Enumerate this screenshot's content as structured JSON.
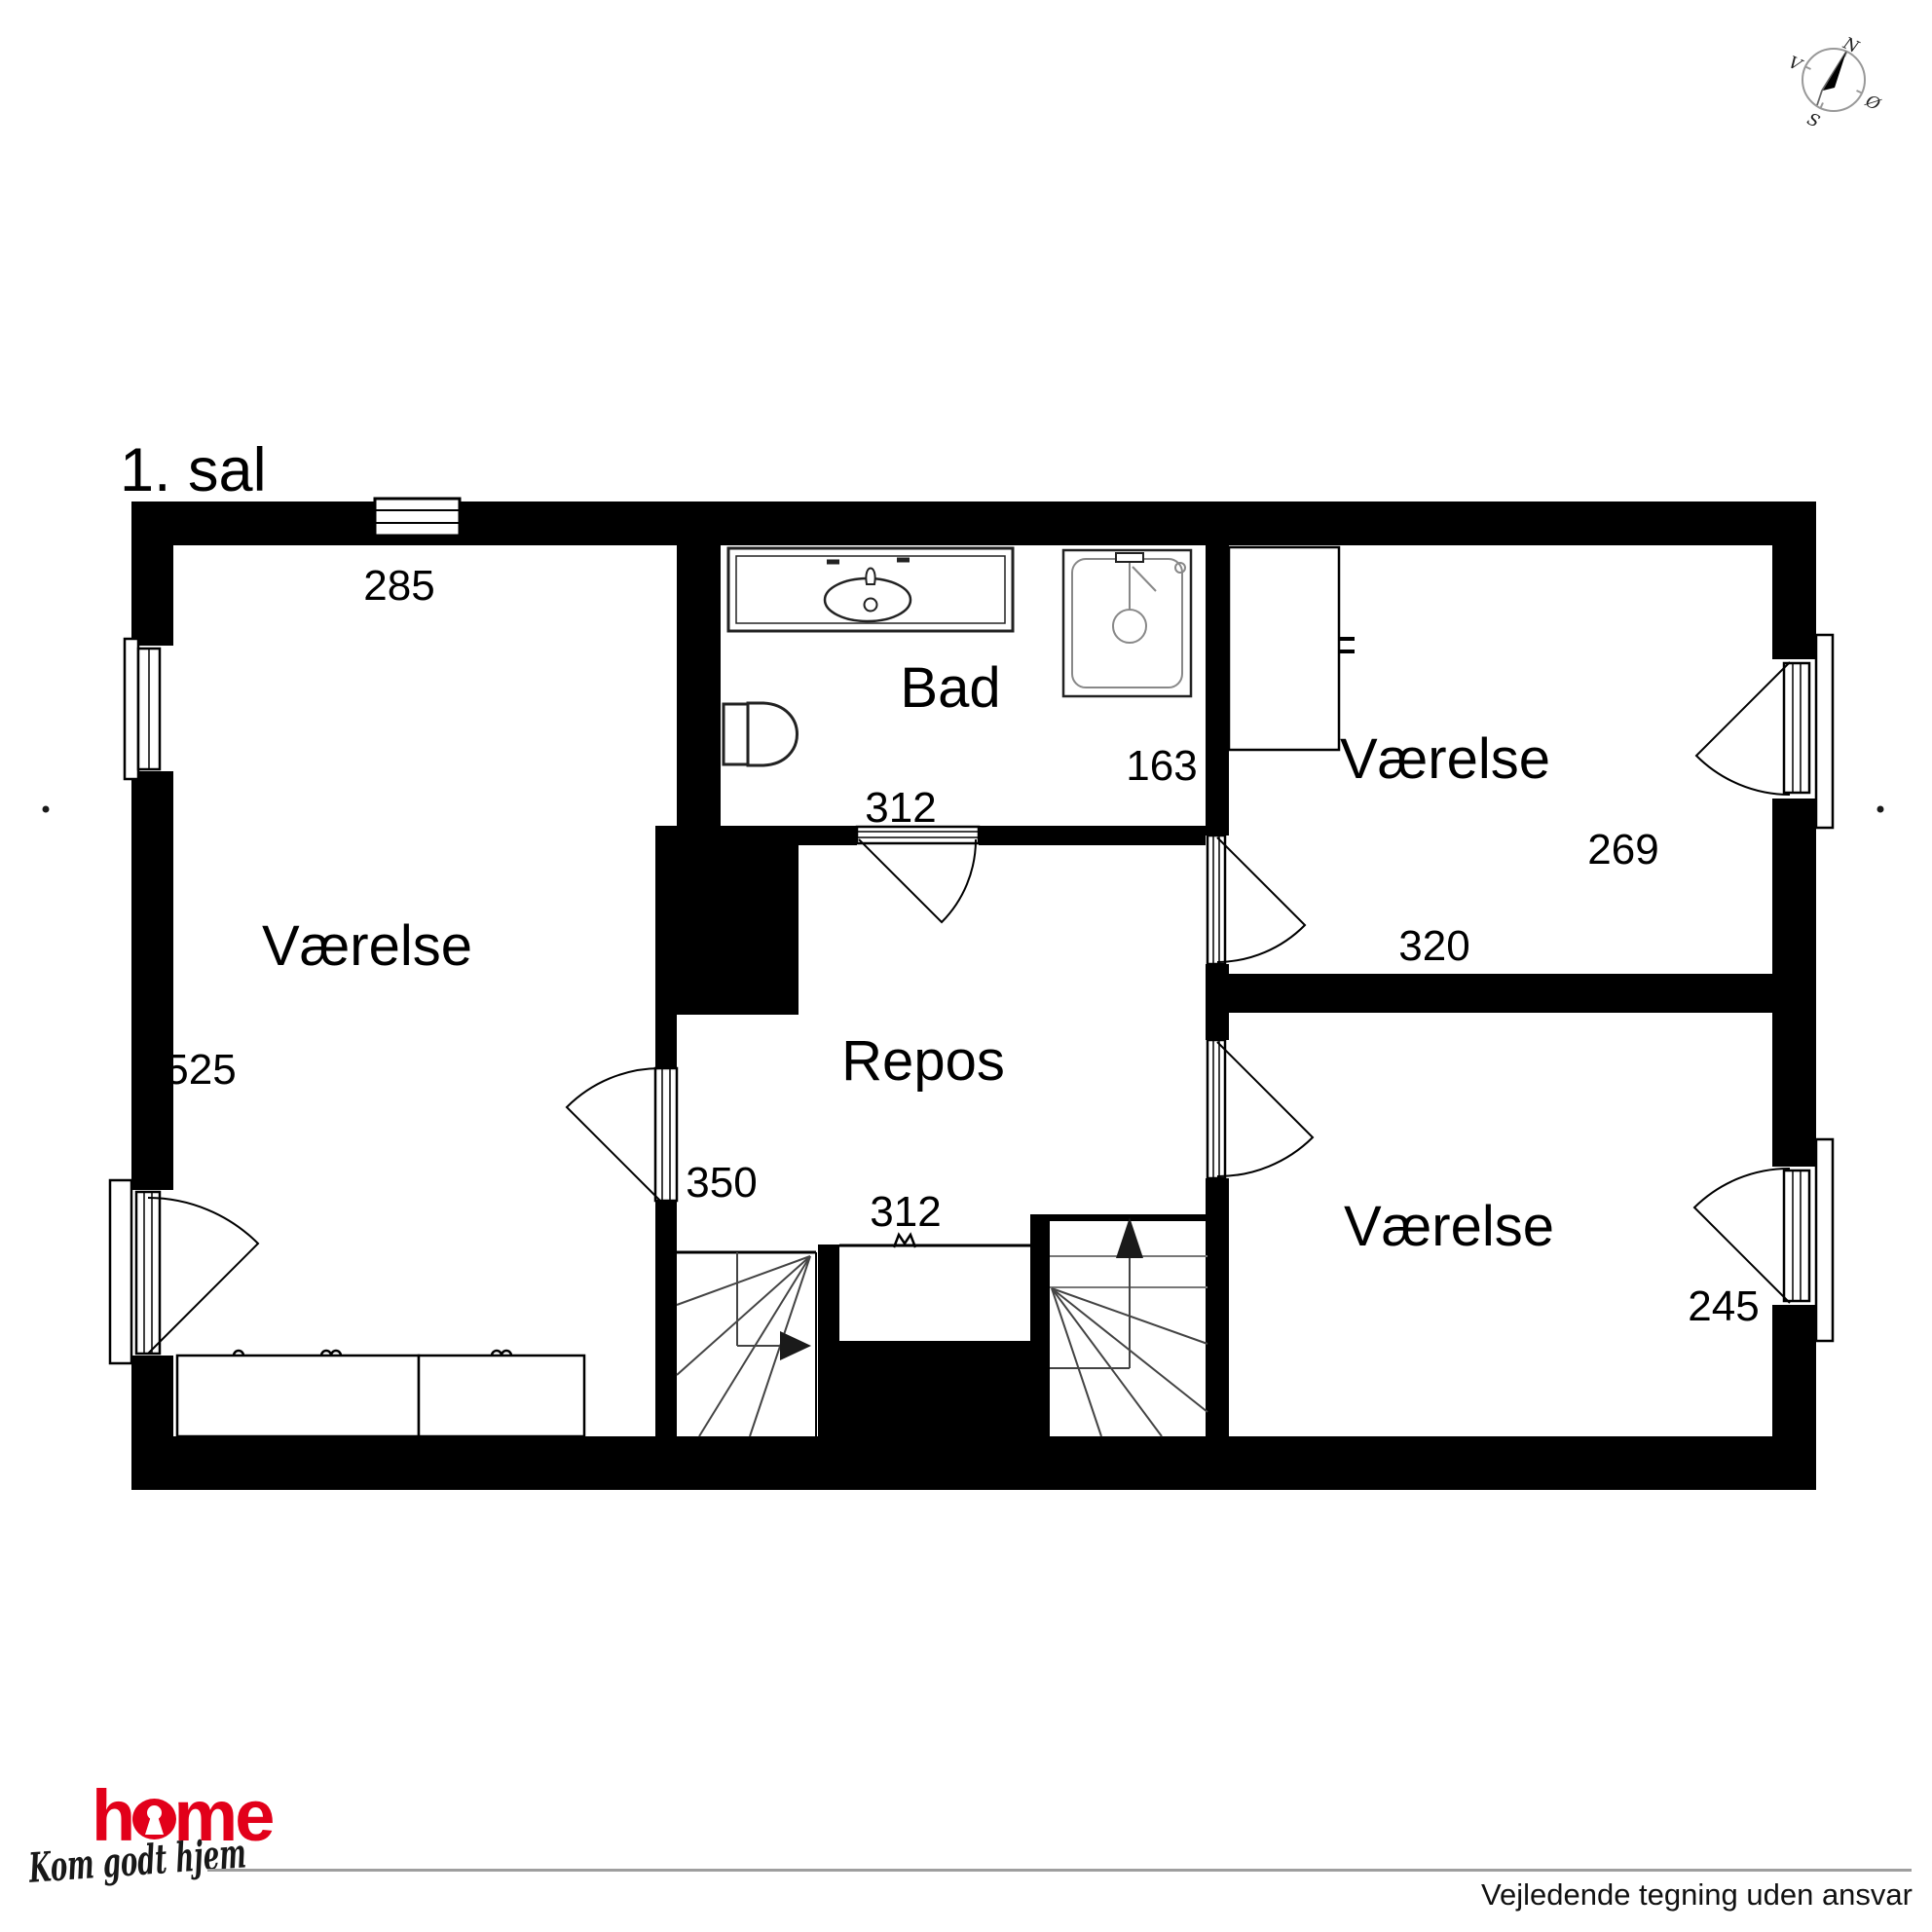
{
  "title": "1. sal",
  "compass": {
    "north": "N",
    "south": "S",
    "west": "V",
    "east": "Ø"
  },
  "rooms": {
    "room_left": {
      "name": "Værelse",
      "width": "285",
      "depth": "525"
    },
    "bath": {
      "name": "Bad",
      "width": "312",
      "depth": "163"
    },
    "landing": {
      "name": "Repos",
      "width": "312",
      "depth": "350"
    },
    "room_top_right": {
      "name": "Værelse",
      "width": "320",
      "depth": "269"
    },
    "room_bottom_right": {
      "name": "Værelse",
      "depth": "245"
    }
  },
  "footer": {
    "brand": "home",
    "brand_h": "h",
    "brand_me": "me",
    "tagline": "Kom godt hjem",
    "disclaimer": "Vejledende tegning uden ansvar"
  }
}
